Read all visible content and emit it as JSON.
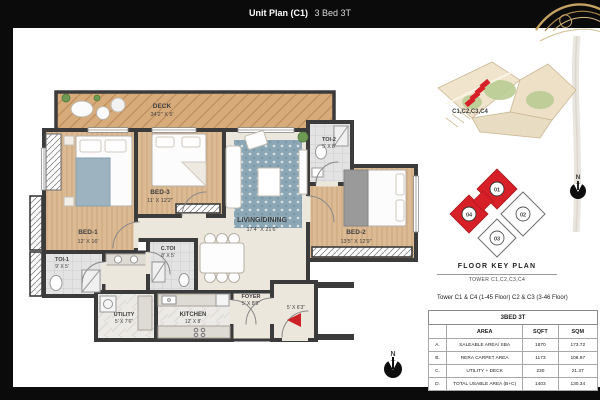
{
  "header": {
    "title_bold": "Unit Plan (C1)",
    "title_rest": "3 Bed 3T"
  },
  "floor_plan": {
    "rooms": [
      {
        "name": "DECK",
        "dim": "34'2\" X 5'"
      },
      {
        "name": "BED-1",
        "dim": "12' X 16'"
      },
      {
        "name": "BED-3",
        "dim": "11' X 12'2\""
      },
      {
        "name": "LIVING/DINING",
        "dim": "17'4\" X 21'6\""
      },
      {
        "name": "TOI-2",
        "dim": "5' X 8'"
      },
      {
        "name": "BED-2",
        "dim": "13'5\" X 12'9\""
      },
      {
        "name": "TOI-1",
        "dim": "9' X 5'"
      },
      {
        "name": "C.TOI",
        "dim": "8' X 5'"
      },
      {
        "name": "UTILITY",
        "dim": "5' X 7'6\""
      },
      {
        "name": "KITCHEN",
        "dim": "12' X 8'"
      },
      {
        "name": "FOYER",
        "dim": "5' X 8'9\""
      }
    ],
    "entry_dim": "5' X 6'3\"",
    "north_label": "N"
  },
  "site_map": {
    "highlight_label": "C1,C2,C3,C4"
  },
  "key_plan": {
    "units": [
      "01",
      "02",
      "03",
      "04"
    ],
    "title": "FLOOR KEY PLAN",
    "subtitle": "TOWER C1,C2,C3,C4",
    "note": "Tower C1 & C4 (1-45 Floor) C2 & C3 (3-46 Floor)",
    "north_label": "N"
  },
  "area_table": {
    "title": "3BED 3T",
    "columns": [
      "",
      "AREA",
      "SQFT",
      "SQM"
    ],
    "rows": [
      {
        "idx": "A.",
        "area": "SALEABLE AREA/ SBA",
        "sqft": "1870",
        "sqm": "173.72"
      },
      {
        "idx": "B.",
        "area": "RERA CARPET AREA",
        "sqft": "1173",
        "sqm": "108.97"
      },
      {
        "idx": "C.",
        "area": "UTILITY + DECK",
        "sqft": "230",
        "sqm": "21.37"
      },
      {
        "idx": "D.",
        "area": "TOTAL USABLE AREA (B+C)",
        "sqft": "1403",
        "sqm": "130.34"
      }
    ]
  },
  "colors": {
    "accent_red": "#cc2127",
    "keyplan_red": "#d61f26",
    "gold": "#c9a567",
    "wall": "#3b3b3b"
  }
}
